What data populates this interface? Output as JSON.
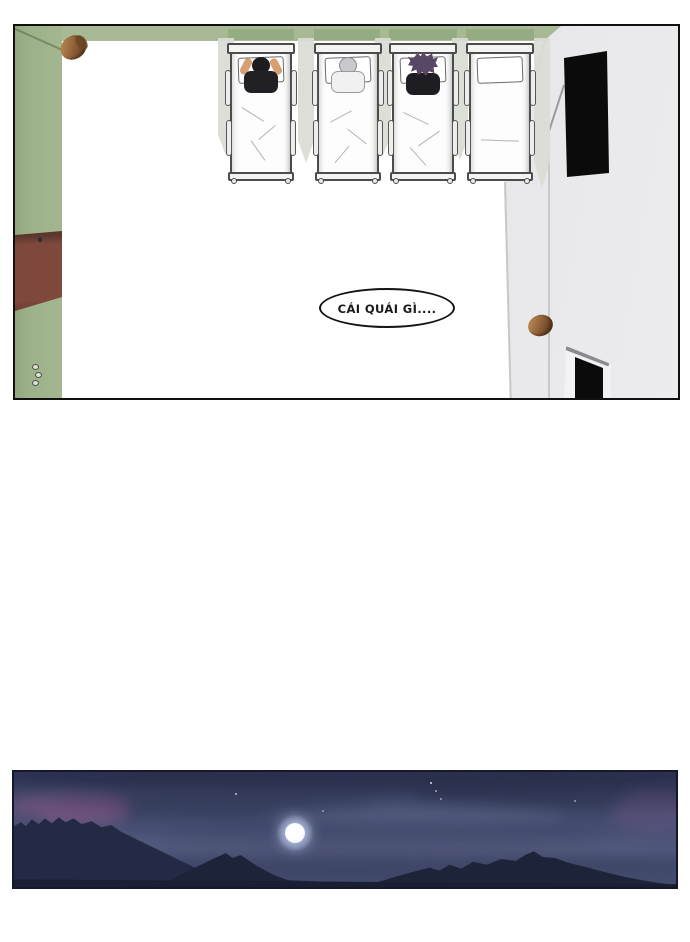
{
  "page": {
    "background": "#ffffff",
    "kind": "webtoon-comic-page"
  },
  "speech_bubble": {
    "text": "CÁI QUÁI GÌ...."
  },
  "room_panel": {
    "view": "top-down dormitory room",
    "beds": [
      {
        "id": 1,
        "occupant": "sleeper-black-hair"
      },
      {
        "id": 2,
        "occupant": "sleeper-gray-hair"
      },
      {
        "id": 3,
        "occupant": "sleeper-purple-spiky-hair"
      },
      {
        "id": 4,
        "occupant": "empty"
      }
    ]
  },
  "night_panel": {
    "scene": "full moon over mountain silhouettes at night"
  },
  "palette": {
    "green_wall_top": "#a8ba95",
    "green_wall_left": "#9cb189",
    "green_wall_shadow": "#8fa67c",
    "door_brown": "#7e483c",
    "peg_brown": "#8a5a36",
    "right_wall": "#e3e3e5",
    "window_black": "#0b0b0b",
    "floor_shadow": "#d9dcd5",
    "panel_border": "#101010",
    "sky_top": "#2d3452",
    "sky_mid": "#464f72",
    "mountain": "#1d2339",
    "moon": "#f7faff"
  }
}
